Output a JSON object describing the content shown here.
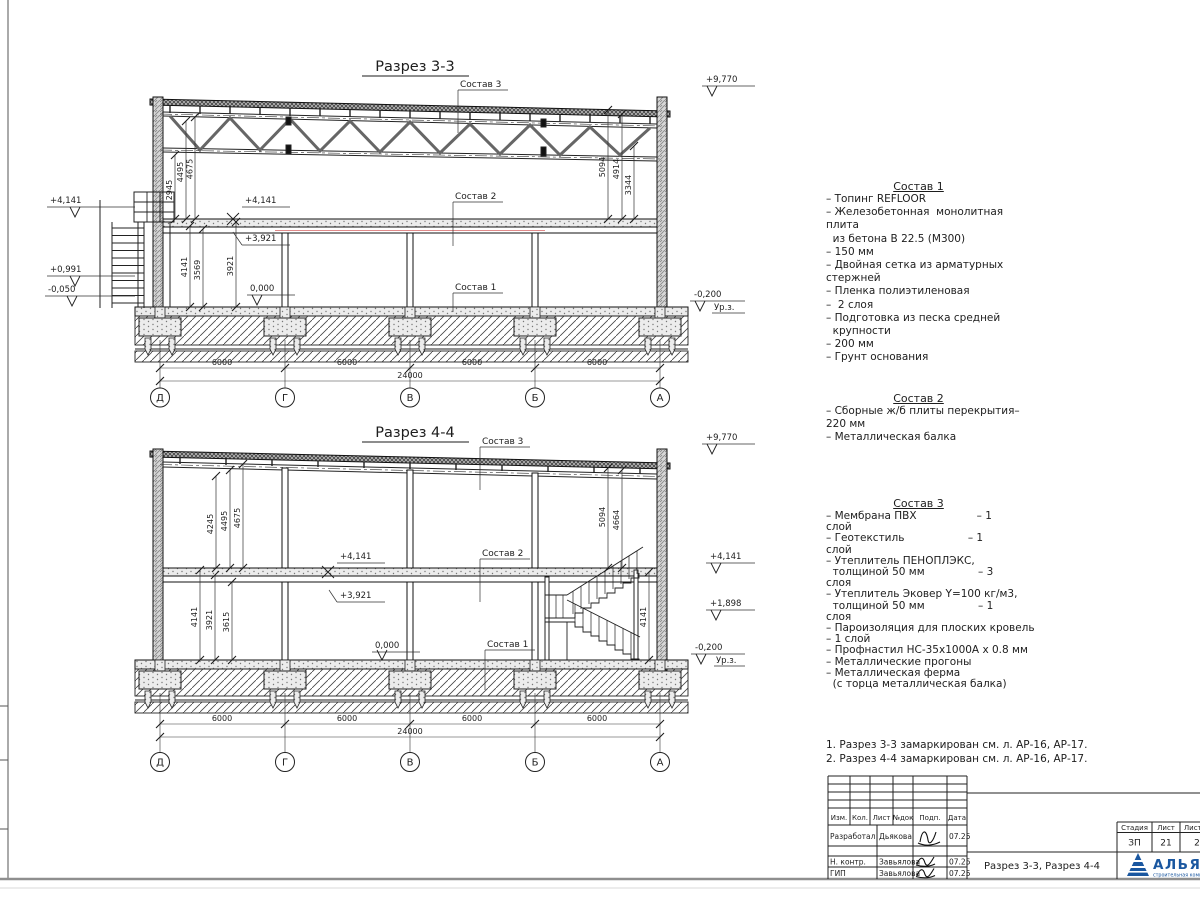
{
  "sheet": {
    "axes": [
      "Д",
      "Г",
      "В",
      "Б",
      "А"
    ],
    "span": "6000",
    "total": "24000",
    "ground_label": "Ур.з."
  },
  "s33": {
    "title": "Разрез 3-3",
    "labels": {
      "c1": "Состав 1",
      "c2": "Состав 2",
      "c3": "Состав 3"
    },
    "elev": {
      "top": "+9,770",
      "slab": "+4,141",
      "mid": "+3,921",
      "zero": "0,000",
      "left_mid": "+0,991",
      "left_low": "-0,050",
      "ground": "-0,200"
    },
    "dims": {
      "ul": [
        "2945",
        "4495",
        "4675"
      ],
      "ll": [
        "4141",
        "3569",
        "3921"
      ],
      "r": [
        "5094",
        "4914",
        "3344"
      ]
    }
  },
  "s44": {
    "title": "Разрез 4-4",
    "labels": {
      "c1": "Состав 1",
      "c2": "Состав 2",
      "c3": "Состав 3"
    },
    "elev": {
      "top": "+9,770",
      "slab": "+4,141",
      "mid": "+3,921",
      "zero": "0,000",
      "stairs": "+1,898",
      "ground": "-0,200"
    },
    "dims": {
      "ul": [
        "4245",
        "4495",
        "4675"
      ],
      "ll": [
        "4141",
        "3921",
        "3615"
      ],
      "r": [
        "5094",
        "4664"
      ],
      "stair": "4141"
    }
  },
  "comp1": {
    "title": "Состав 1",
    "lines": [
      "– Топинг REFLOOR",
      "– Железобетонная  монолитная",
      "плита",
      "  из бетона В 22.5 (М300)",
      "– 150 мм",
      "– Двойная сетка из арматурных",
      "стержней",
      "– Пленка полиэтиленовая",
      "–  2 слоя",
      "– Подготовка из песка средней",
      "  крупности",
      "– 200 мм",
      "– Грунт основания"
    ]
  },
  "comp2": {
    "title": "Состав 2",
    "lines": [
      "– Сборные ж/б плиты перекрытия–",
      "220 мм",
      "– Металлическая балка"
    ]
  },
  "comp3": {
    "title": "Состав 3",
    "lines": [
      "– Мембрана ПВХ                  – 1",
      "слой",
      "– Геотекстиль                   – 1",
      "слой",
      "– Утеплитель ПЕНОПЛЭКС,",
      "  толщиной 50 мм                – 3",
      "слоя",
      "– Утеплитель Эковер Y=100 кг/м3,",
      "  толщиной 50 мм                – 1",
      "слоя",
      "– Пароизоляция для плоских кровель",
      "– 1 слой",
      "– Профнастил НС-35х1000А х 0.8 мм",
      "– Металлические прогоны",
      "– Металлическая ферма",
      "  (с торца металлическая балка)"
    ]
  },
  "notes": [
    "1. Разрез 3-3 замаркирован см. л. АР-16, АР-17.",
    "2. Разрез 4-4 замаркирован см. л. АР-16, АР-17."
  ],
  "titleblock": {
    "cols": [
      "Изм.",
      "Кол.",
      "Лист",
      "№док",
      "Подп.",
      "Дата"
    ],
    "rows": [
      {
        "role": "Разработал",
        "name": "Дьякова",
        "date": "07.25"
      },
      {
        "role": "Н. контр.",
        "name": "Завьялова",
        "date": "07.25"
      },
      {
        "role": "ГИП",
        "name": "Завьялова",
        "date": "07.25"
      }
    ],
    "doc_title": "Разрез 3-3, Разрез 4-4",
    "stage_cols": [
      "Стадия",
      "Лист",
      "Листов"
    ],
    "stage_vals": [
      "ЗП",
      "21",
      "2"
    ],
    "logo": {
      "name": "АЛЬЯНС",
      "sub": "строительная компания",
      "color": "#1a57a0"
    }
  }
}
